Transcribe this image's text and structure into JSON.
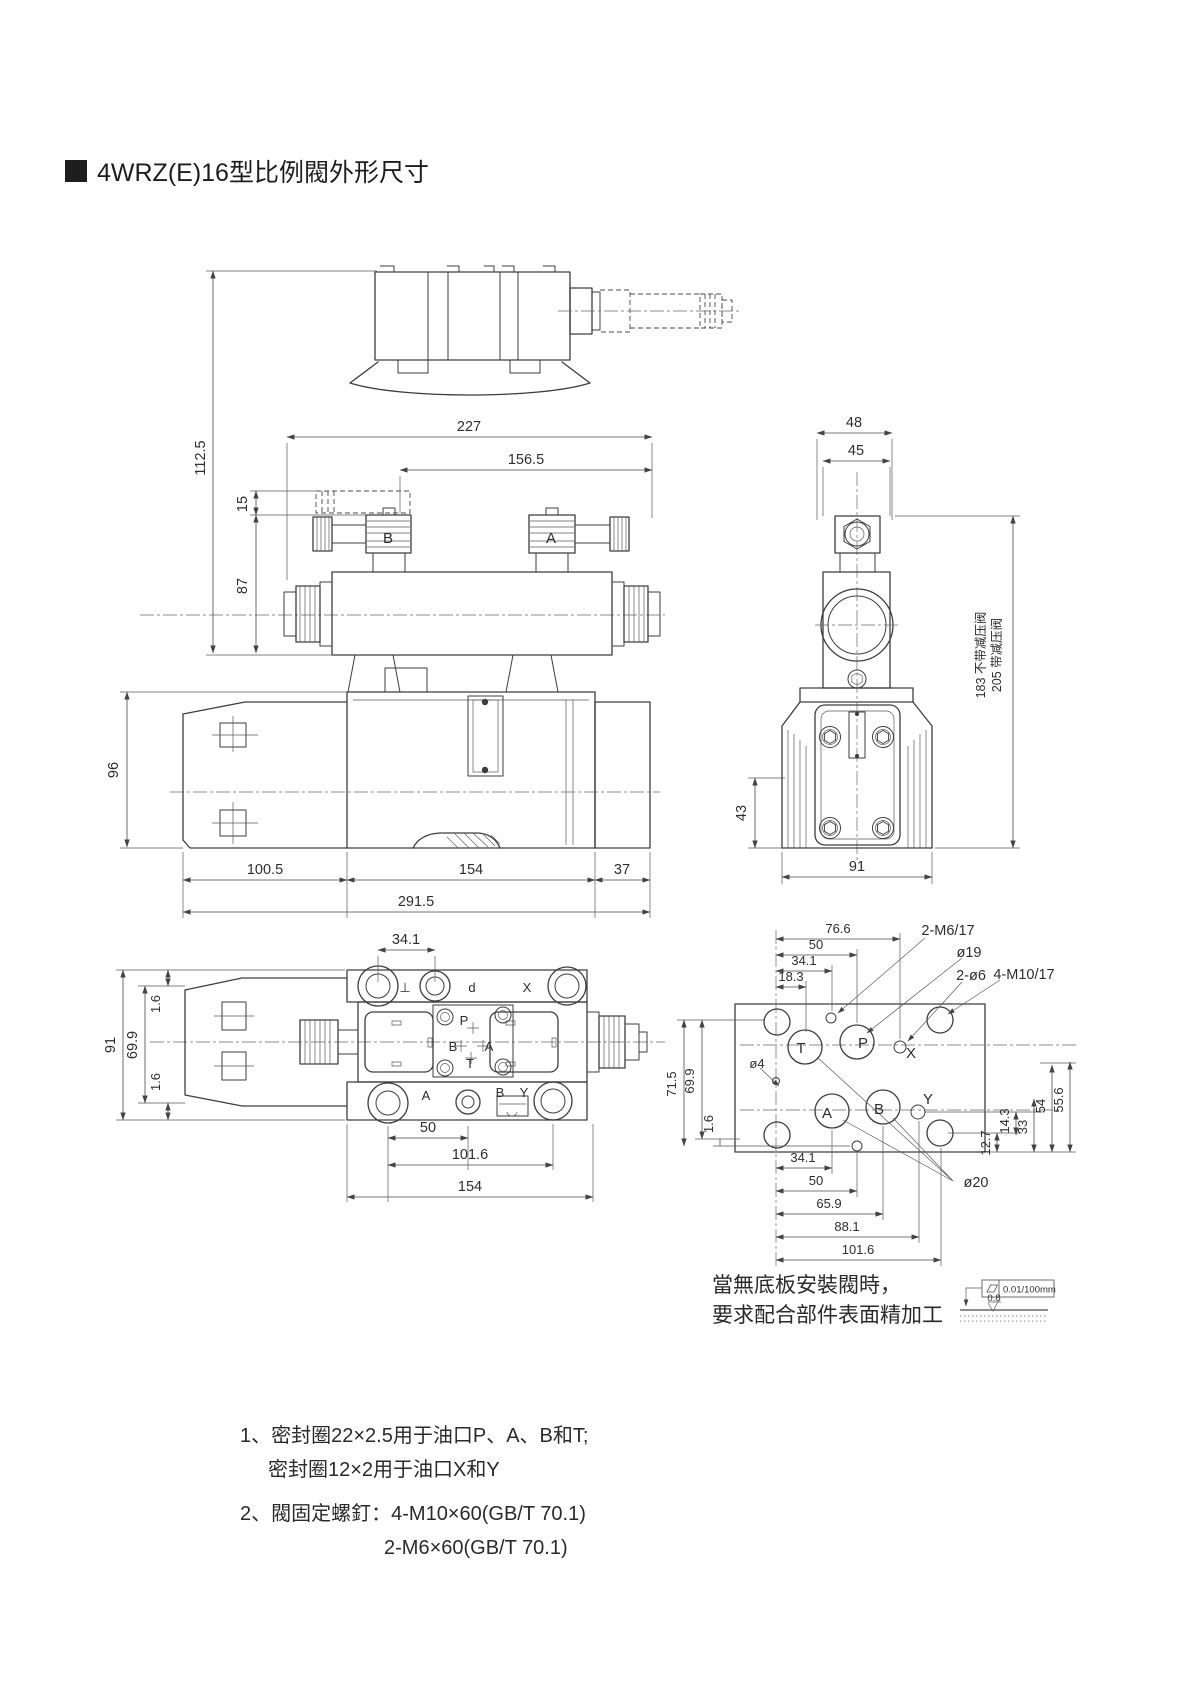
{
  "page": {
    "title": "4WRZ(E)16型比例閥外形尺寸"
  },
  "front_view": {
    "solenoid_b": "B",
    "solenoid_a": "A",
    "dim_227": "227",
    "dim_156_5": "156.5",
    "dim_112_5": "112.5",
    "dim_15": "15",
    "dim_87": "87",
    "dim_96": "96",
    "dim_100_5": "100.5",
    "dim_154": "154",
    "dim_37": "37",
    "dim_291_5": "291.5"
  },
  "side_view": {
    "dim_48": "48",
    "dim_45": "45",
    "dim_43": "43",
    "dim_91": "91",
    "height_without_reducer": "183 不带减压阀",
    "height_with_reducer": "205 带减压阀"
  },
  "bottom_view": {
    "dim_34_1": "34.1",
    "dim_91": "91",
    "dim_69_9": "69.9",
    "dim_1_6_top": "1.6",
    "dim_1_6_bottom": "1.6",
    "dim_50": "50",
    "dim_101_6": "101.6",
    "dim_154": "154",
    "label_t_rotated": "⊥",
    "label_p_rotated": "d",
    "label_x": "X",
    "port_p": "P",
    "port_b": "B",
    "port_a": "A",
    "port_t": "T",
    "label_a": "A",
    "label_b": "B",
    "label_y": "Y"
  },
  "plate_view": {
    "dim_76_6": "76.6",
    "dim_50_top": "50",
    "dim_34_1_top": "34.1",
    "dim_18_3": "18.3",
    "callout_m6": "2-M6/17",
    "callout_d19": "ø19",
    "callout_d6": "2-ø6",
    "callout_m10": "4-M10/17",
    "callout_d4": "ø4",
    "callout_d20": "ø20",
    "port_t": "T",
    "port_p": "P",
    "port_x": "X",
    "port_a": "A",
    "port_b": "B",
    "port_y": "Y",
    "dim_71_5": "71.5",
    "dim_69_9": "69.9",
    "dim_1_6": "1.6",
    "dim_14_3": "14.3",
    "dim_33": "33",
    "dim_54": "54",
    "dim_55_6": "55.6",
    "dim_12_7": "12.7",
    "dim_34_1_bottom": "34.1",
    "dim_50_bottom": "50",
    "dim_65_9": "65.9",
    "dim_88_1": "88.1",
    "dim_101_6": "101.6"
  },
  "surface_note": {
    "line1": "當無底板安裝閥時，",
    "line2": "要求配合部件表面精加工",
    "flatness": "0.01/100mm",
    "roughness": "0.8"
  },
  "notes": {
    "item1_line1": "1、密封圈22×2.5用于油口P、A、B和T;",
    "item1_line2": "密封圈12×2用于油口X和Y",
    "item2_line1": "2、閥固定螺釘：4-M10×60(GB/T 70.1)",
    "item2_line2": "2-M6×60(GB/T 70.1)"
  }
}
